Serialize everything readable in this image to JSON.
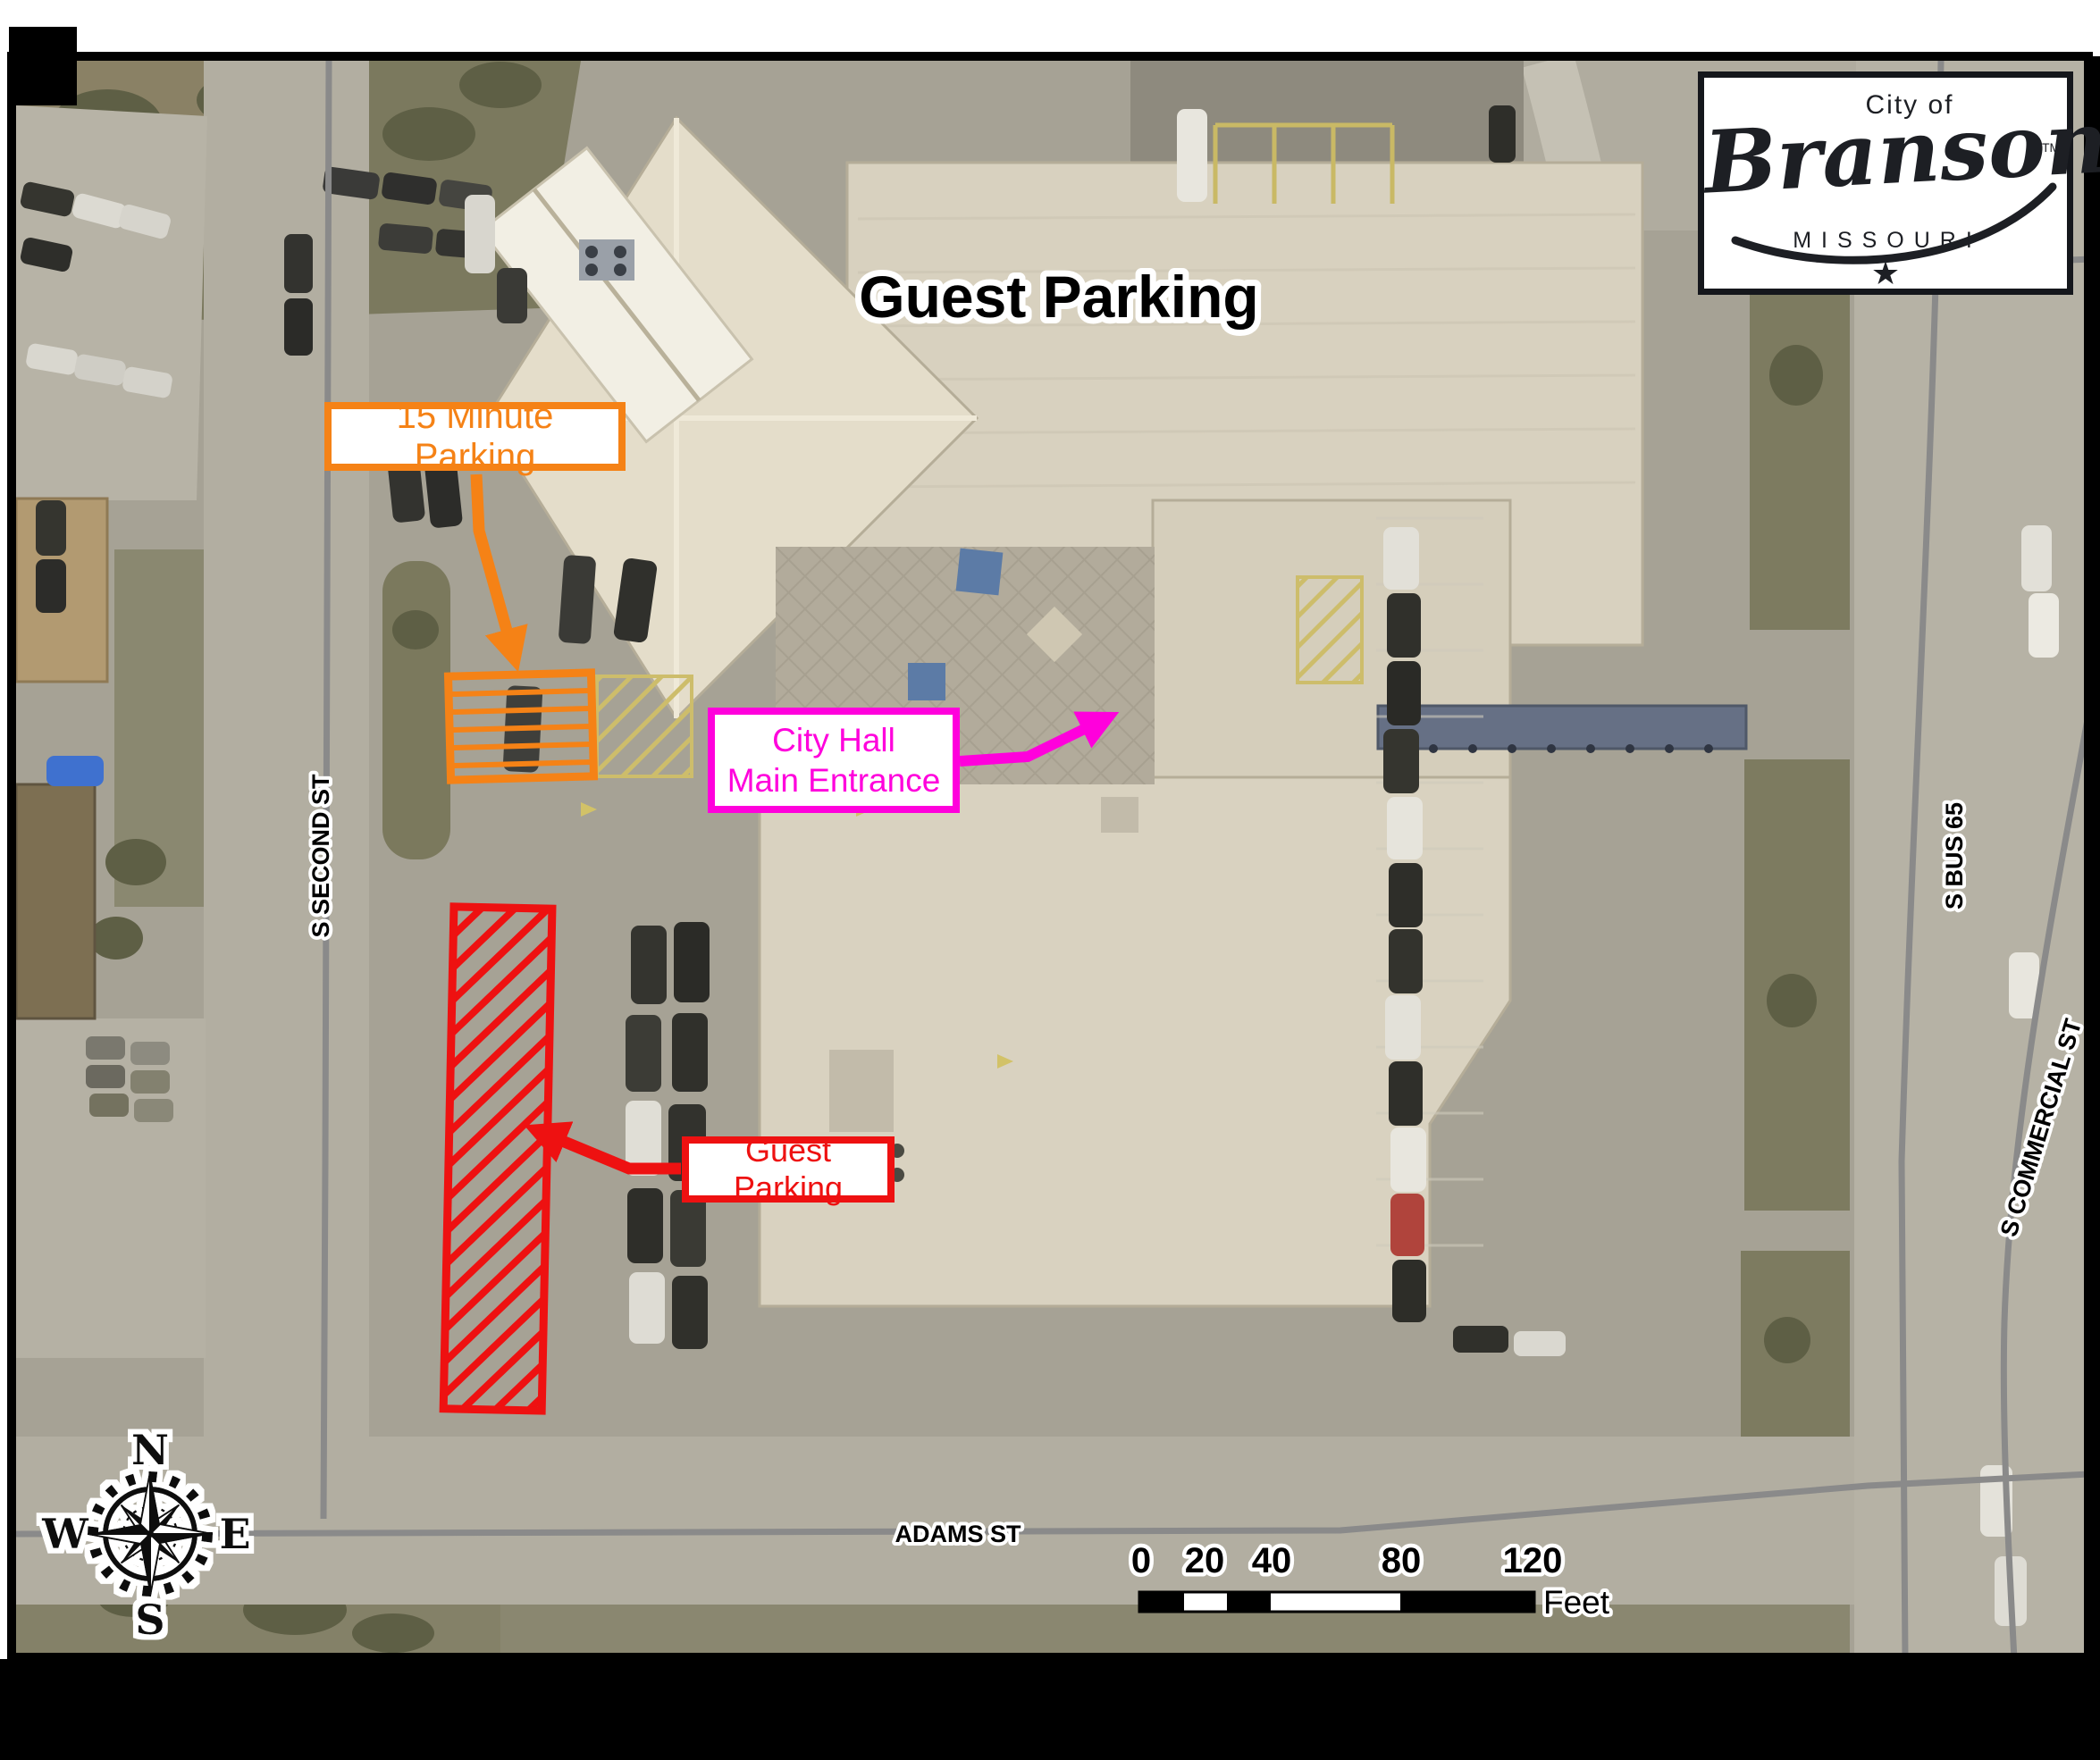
{
  "title": "Guest Parking",
  "annotations": {
    "fifteen_minute": {
      "label": "15 Minute Parking",
      "color": "#F58216"
    },
    "city_hall": {
      "line1": "City Hall",
      "line2": "Main Entrance",
      "color": "#FF00DC"
    },
    "guest_parking": {
      "label": "Guest Parking",
      "color": "#EE1111"
    }
  },
  "streets": {
    "second": "S SECOND ST",
    "adams": "ADAMS ST",
    "bus65": "S BUS 65",
    "commercial": "S COMMERCIAL ST"
  },
  "compass": {
    "n": "N",
    "e": "E",
    "s": "S",
    "w": "W"
  },
  "scalebar": {
    "ticks": [
      "0",
      "20",
      "40",
      "80",
      "120"
    ],
    "unit": "Feet"
  },
  "logo": {
    "city_of": "City of",
    "name": "Branson",
    "tm": "TM",
    "state": "MISSOURI",
    "star": "★"
  },
  "colors": {
    "map_border": "#000000",
    "road_line": "#8a8a8a"
  }
}
